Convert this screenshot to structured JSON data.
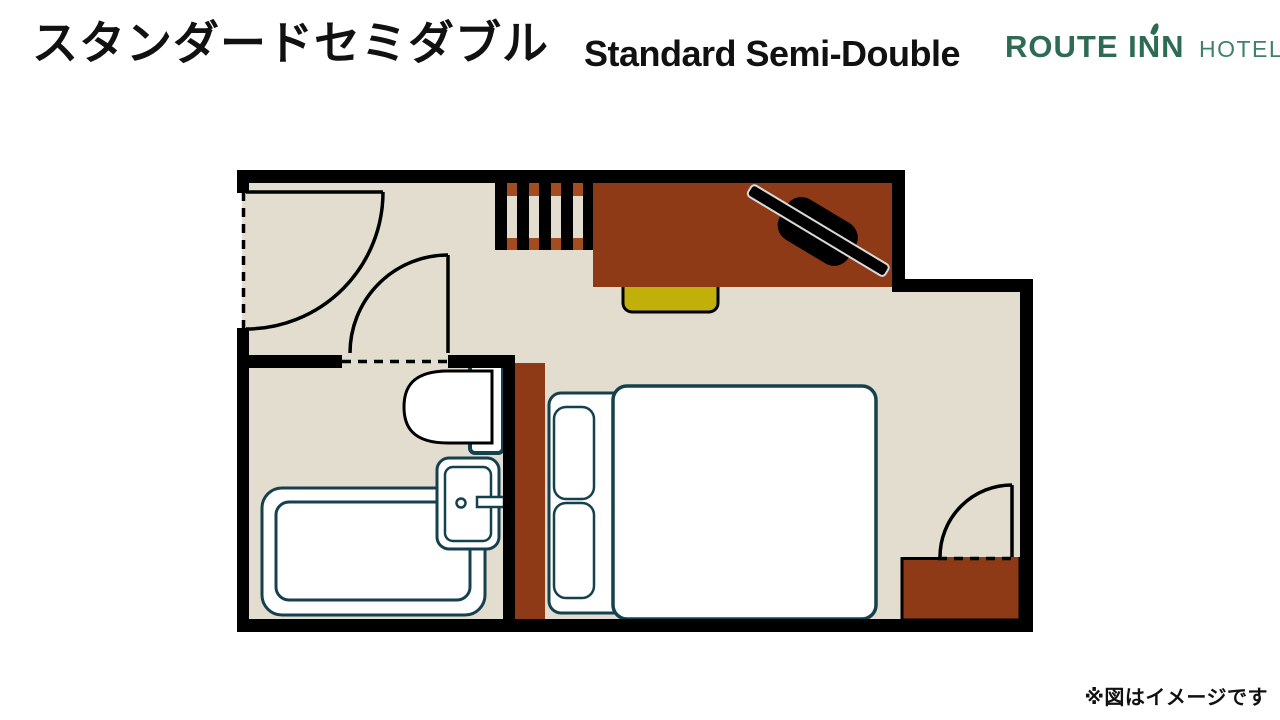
{
  "header": {
    "title_ja": "スタンダードセミダブル",
    "title_en": "Standard Semi-Double",
    "logo": {
      "brand": "ROUTE INN",
      "suffix": "HOTELS",
      "accent_icon": "leaf-accent"
    }
  },
  "footer": {
    "note": "※図はイメージです"
  },
  "floorplan": {
    "rooms": [
      "entrance",
      "bathroom",
      "bedroom"
    ],
    "furniture": [
      "entrance-door",
      "inner-door",
      "luggage-rack",
      "desk",
      "office-chair",
      "stool",
      "wardrobe-panel",
      "toilet",
      "washbasin",
      "bathtub",
      "bed-frame",
      "pillow",
      "pillow",
      "semi-double-mattress",
      "room-door",
      "cabinet"
    ]
  },
  "colors": {
    "c_bg": "#ffffff",
    "c_text": "#111111",
    "c_green": "#2d6b52",
    "c_green_light": "#41806c",
    "c_floor": "#e3ddd0",
    "c_wood": "#8e3a17",
    "c_rack": "#a24c20",
    "c_stool": "#c1b00a",
    "c_teal": "#15404e",
    "c_wall": "#000000"
  }
}
